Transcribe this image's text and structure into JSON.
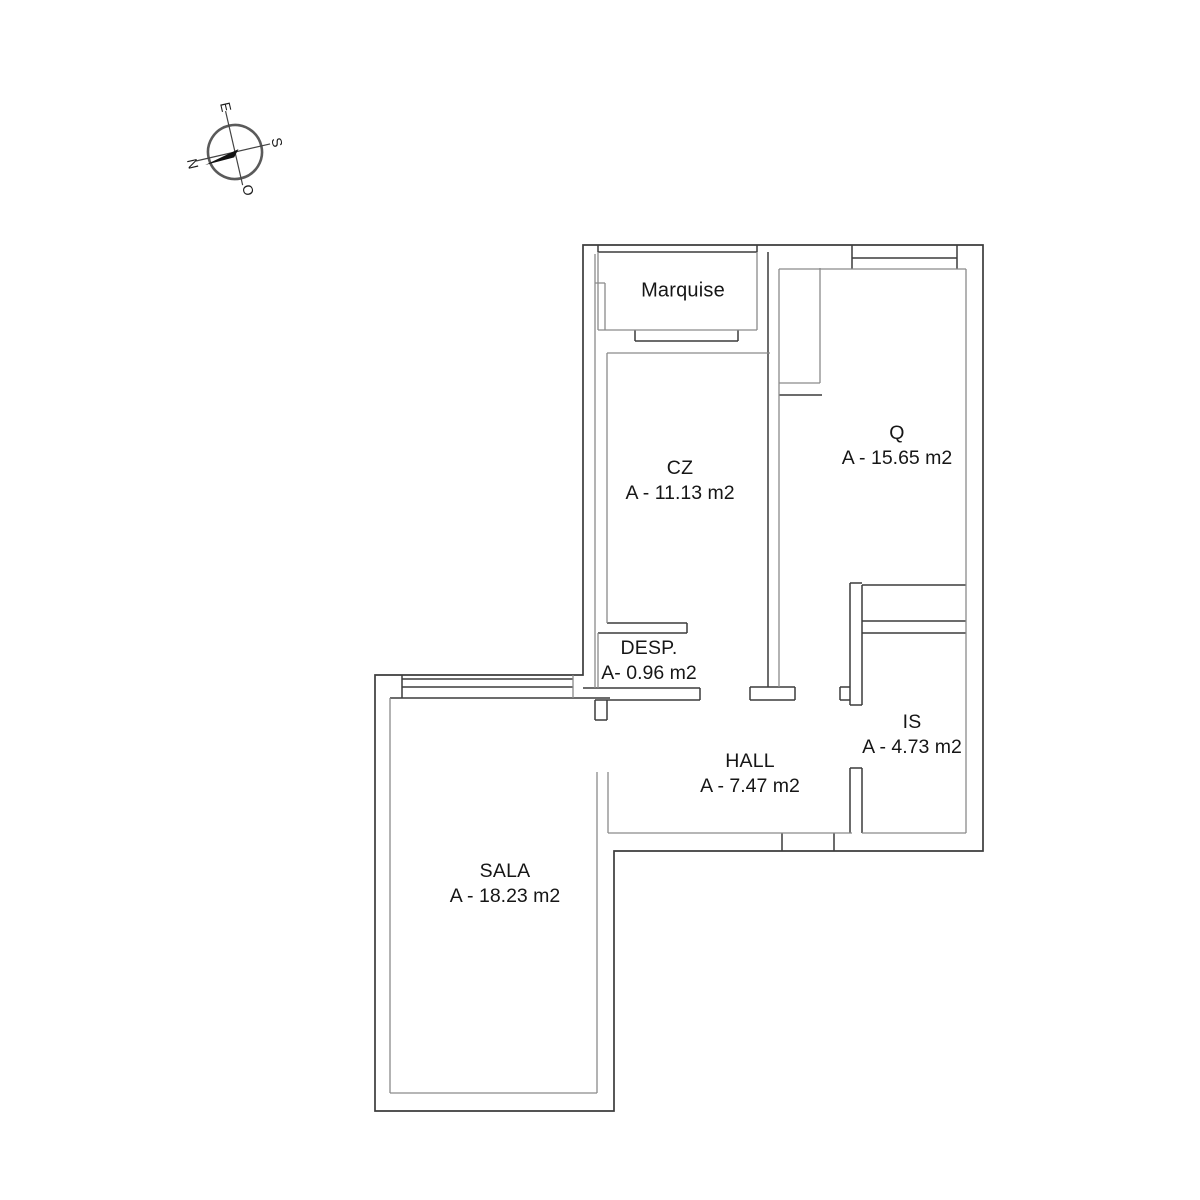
{
  "compass": {
    "n": "N",
    "e": "E",
    "s": "S",
    "o": "O"
  },
  "rooms": {
    "marquise": {
      "name": "Marquise"
    },
    "cz": {
      "name": "CZ",
      "area": "A - 11.13 m2"
    },
    "q": {
      "name": "Q",
      "area": "A - 15.65 m2"
    },
    "desp": {
      "name": "DESP.",
      "area": "A- 0.96 m2"
    },
    "is": {
      "name": "IS",
      "area": "A - 4.73 m2"
    },
    "hall": {
      "name": "HALL",
      "area": "A - 7.47 m2"
    },
    "sala": {
      "name": "SALA",
      "area": "A - 18.23 m2"
    }
  },
  "colors": {
    "wall_dark": "#3c3c3c",
    "wall_gray": "#8a8a8a",
    "text": "#161616",
    "background": "#ffffff"
  }
}
